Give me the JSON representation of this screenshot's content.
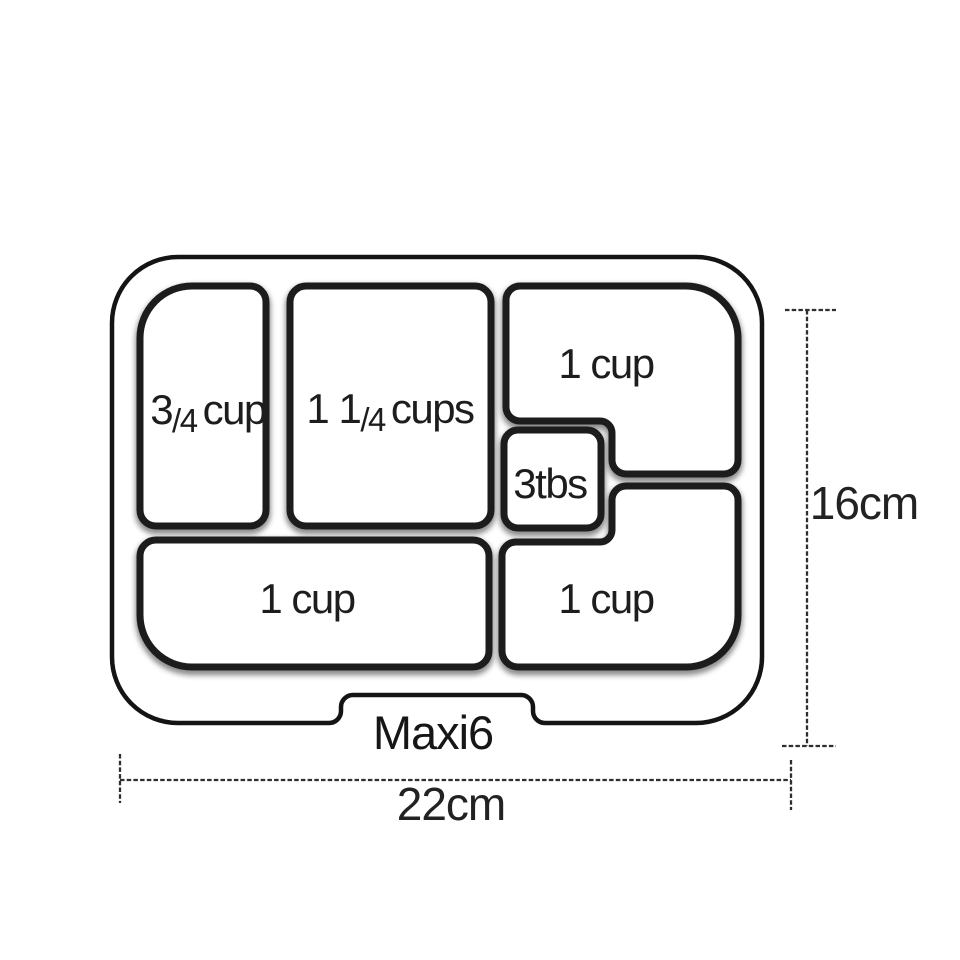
{
  "diagram": {
    "model_label": "Maxi6",
    "dimensions": {
      "height": "16cm",
      "width": "22cm"
    },
    "compartments": {
      "top_left": {
        "whole": "3",
        "fraction": "/4",
        "unit": "cup"
      },
      "top_middle": {
        "whole": "1 1",
        "fraction": "/4",
        "unit": "cups"
      },
      "top_right": {
        "label": "1 cup"
      },
      "small_center": {
        "label": "3tbs"
      },
      "bottom_left": {
        "label": "1 cup"
      },
      "bottom_right": {
        "label": "1 cup"
      }
    },
    "colors": {
      "tray_outline": "#141414",
      "compartment_stroke": "#1c1c1c",
      "text": "#1d1d1d",
      "dimension_lines": "#2f2f2f",
      "background": "#ffffff"
    }
  }
}
